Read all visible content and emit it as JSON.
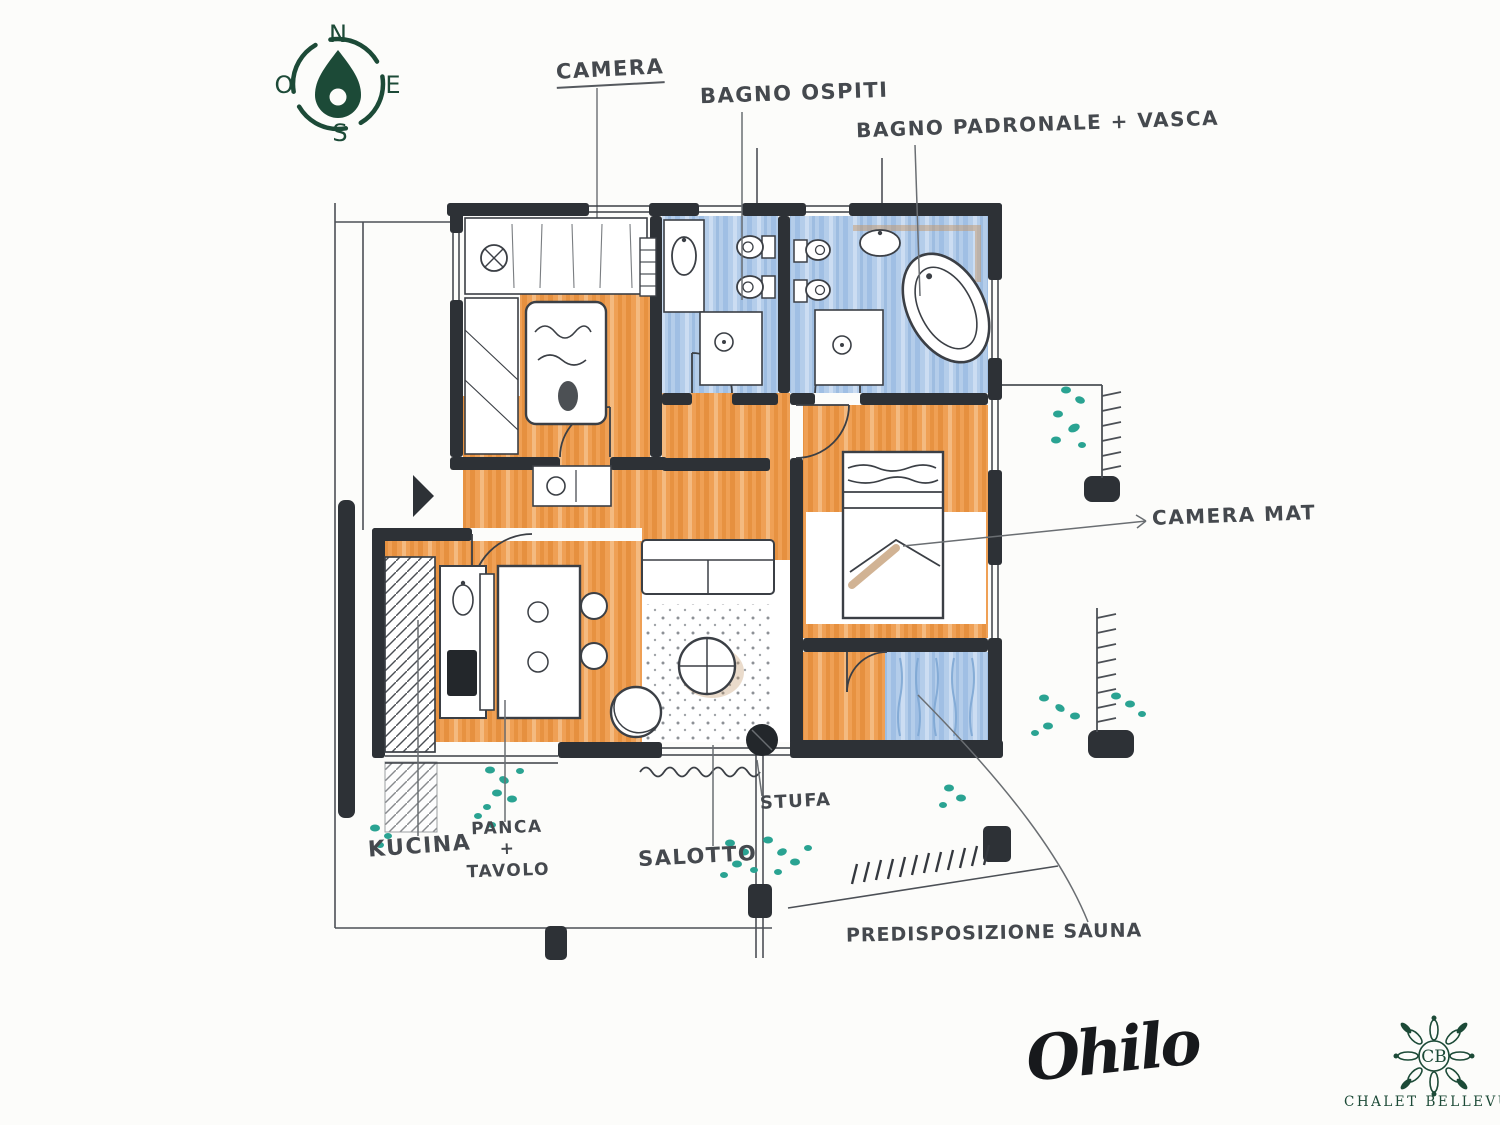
{
  "compass": {
    "north": "N",
    "east": "E",
    "south": "S",
    "west": "O"
  },
  "labels": {
    "camera": "CAMERA",
    "bagno_ospiti": "BAGNO OSPITI",
    "bagno_padronale": "BAGNO PADRONALE + VASCA",
    "camera_mat": "CAMERA MAT",
    "kucina": "KUCINA",
    "panca_tavolo": "PANCA\n+\nTAVOLO",
    "salotto": "SALOTTO",
    "stufa": "STUFA",
    "predisposizione_sauna": "PREDISPOSIZIONE SAUNA"
  },
  "signature": "Ohilo",
  "logo": {
    "monogram": "CB",
    "name": "CHALET BELLEVUE"
  },
  "colors": {
    "wall": "#2d3136",
    "ink": "#3b3f45",
    "floor_orange": "#efa055",
    "floor_orange_stripe": "#e28a38",
    "floor_blue": "#b4cdea",
    "floor_blue_stripe": "#9bbce2",
    "plant_teal": "#2aa392",
    "brand_green": "#1c4a37",
    "accent_brown": "#c4976a"
  }
}
